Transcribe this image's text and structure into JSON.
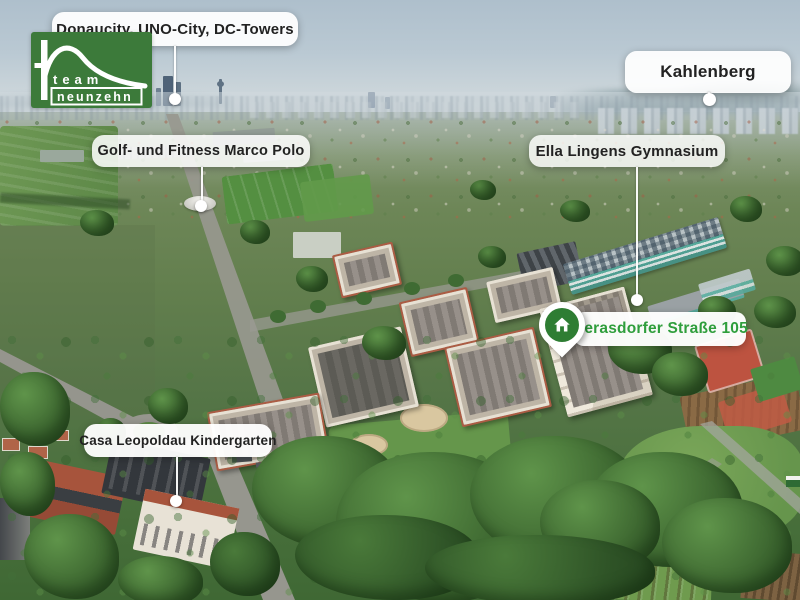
{
  "brand": {
    "name_line1": "team",
    "name_line2": "neunzehn",
    "bg_color": "#3c7a3a"
  },
  "callouts": [
    {
      "id": "donaucity",
      "label": "Donaucity, UNO-City, DC-Towers"
    },
    {
      "id": "kahlenberg",
      "label": "Kahlenberg"
    },
    {
      "id": "golf-fitness-marco-polo",
      "label": "Golf- und Fitness Marco Polo"
    },
    {
      "id": "ella-lingens-gymnasium",
      "label": "Ella Lingens Gymnasium"
    },
    {
      "id": "casa-leopoldau-kindergarten",
      "label": "Casa Leopoldau Kindergarten"
    }
  ],
  "address_marker": {
    "label": "Gerasdorfer Straße 105",
    "icon": "house-icon",
    "pin_color": "#2e7d33",
    "text_color": "#2f9e3c"
  }
}
